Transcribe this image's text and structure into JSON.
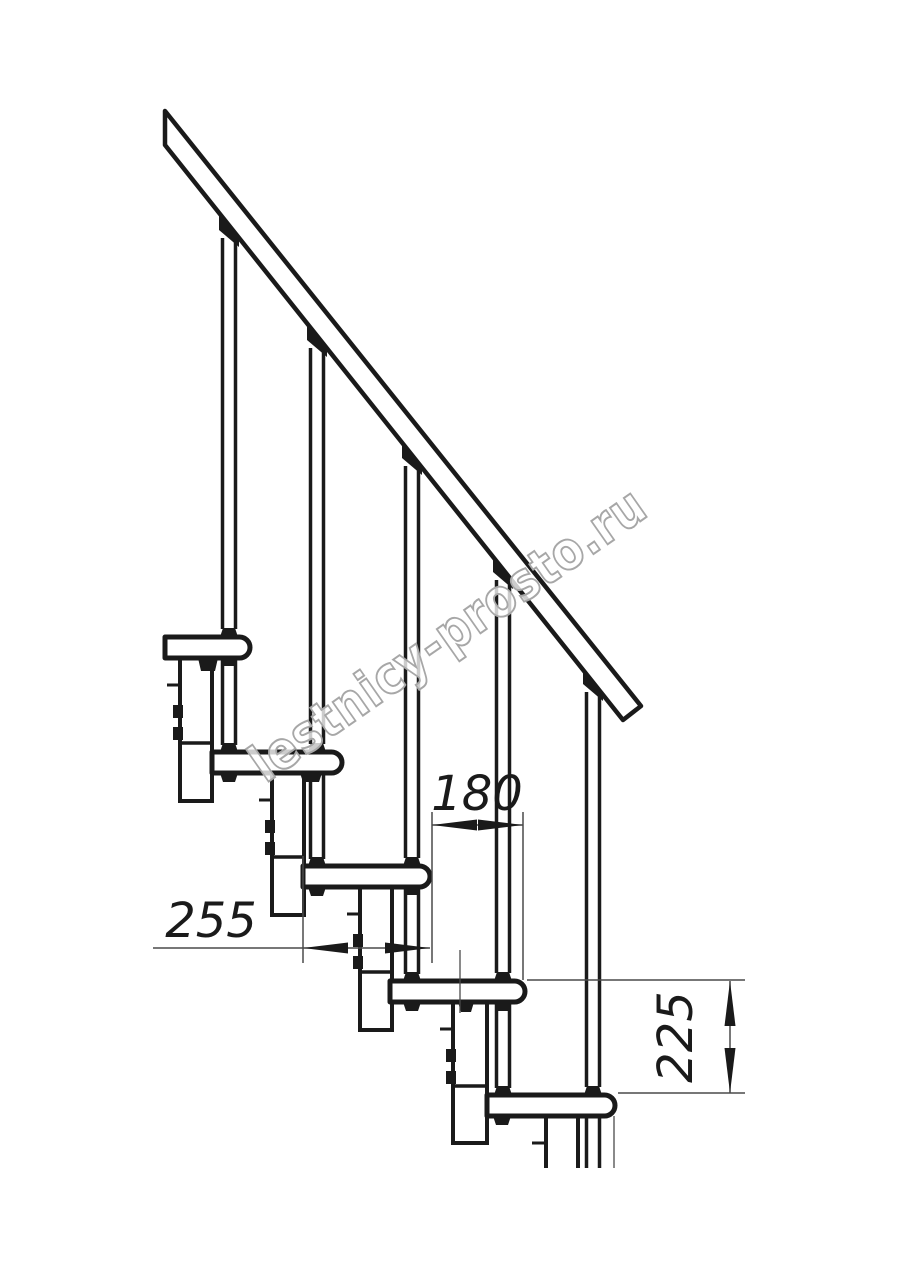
{
  "meta": {
    "type": "technical line drawing",
    "subject": "modular staircase side elevation with railing",
    "background_color": "#ffffff",
    "line_color": "#1a1a1a",
    "thin_line_color": "#4a4a4a"
  },
  "watermark": {
    "text": "lestnicy-prosto.ru",
    "color": "#a7a7a7",
    "angle_deg": -35
  },
  "dimensions": [
    {
      "id": "dim-180",
      "label": "180",
      "orientation": "horizontal",
      "measures": "step run between tread noses"
    },
    {
      "id": "dim-255",
      "label": "255",
      "orientation": "horizontal",
      "measures": "tread depth"
    },
    {
      "id": "dim-225",
      "label": "225",
      "orientation": "vertical",
      "measures": "step rise between treads"
    }
  ],
  "parts": {
    "handrail": 1,
    "balusters": 5,
    "treads": 5,
    "support_modules": 5
  }
}
